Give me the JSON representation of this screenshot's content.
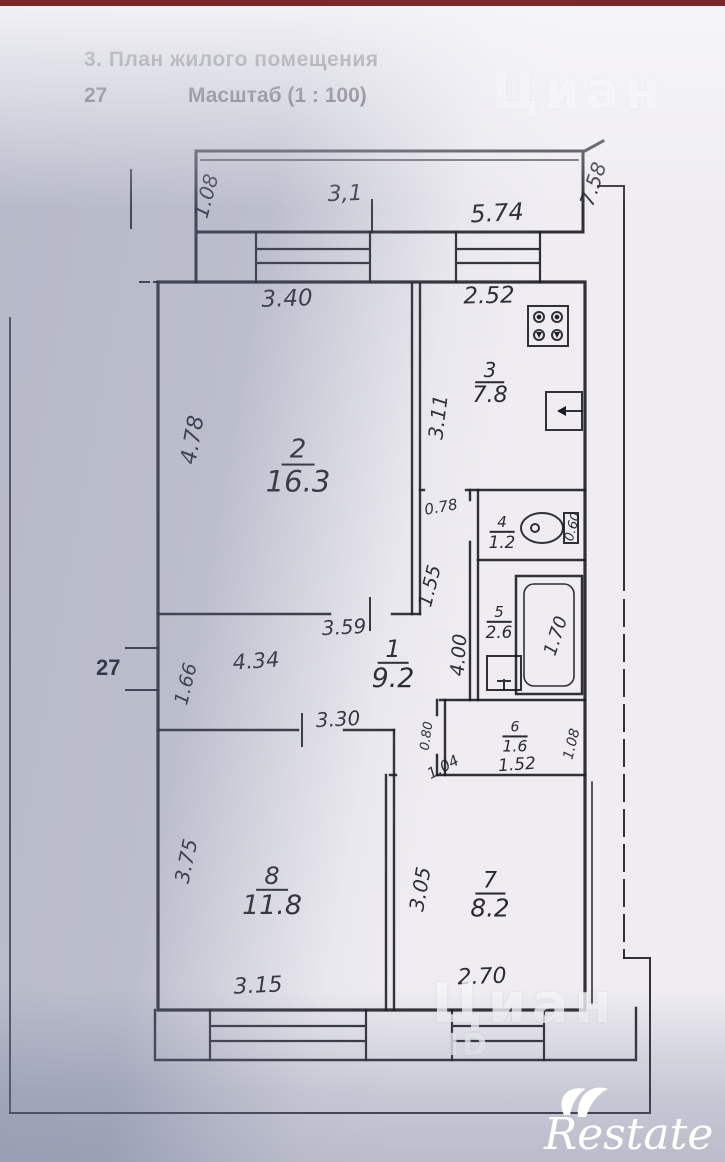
{
  "header": {
    "section_title": "3. План жилого помещения",
    "page_number": "27",
    "scale_label": "Масштаб (1 : 100)"
  },
  "plan": {
    "margin_label": "27",
    "balcony_top_area": "3,1",
    "rooms": [
      {
        "number": "1",
        "area": "9.2"
      },
      {
        "number": "2",
        "area": "16.3"
      },
      {
        "number": "3",
        "area": "7.8"
      },
      {
        "number": "4",
        "area": "1.2"
      },
      {
        "number": "5",
        "area": "2.6"
      },
      {
        "number": "6",
        "area": "1.6"
      },
      {
        "number": "7",
        "area": "8.2"
      },
      {
        "number": "8",
        "area": "11.8"
      }
    ],
    "dimensions": [
      "5.74",
      "1.08",
      "7.58",
      "3.40",
      "2.52",
      "3.11",
      "4.78",
      "1.55",
      "0.78",
      "0.60",
      "1.70",
      "3.59",
      "4.34",
      "1.66",
      "4.00",
      "3.30",
      "0.80",
      "1.04",
      "1.52",
      "1.08",
      "3.75",
      "3.15",
      "3.05",
      "2.70"
    ]
  },
  "watermarks": {
    "site": "Циан",
    "id_label": "ID",
    "brand": "Restate"
  }
}
